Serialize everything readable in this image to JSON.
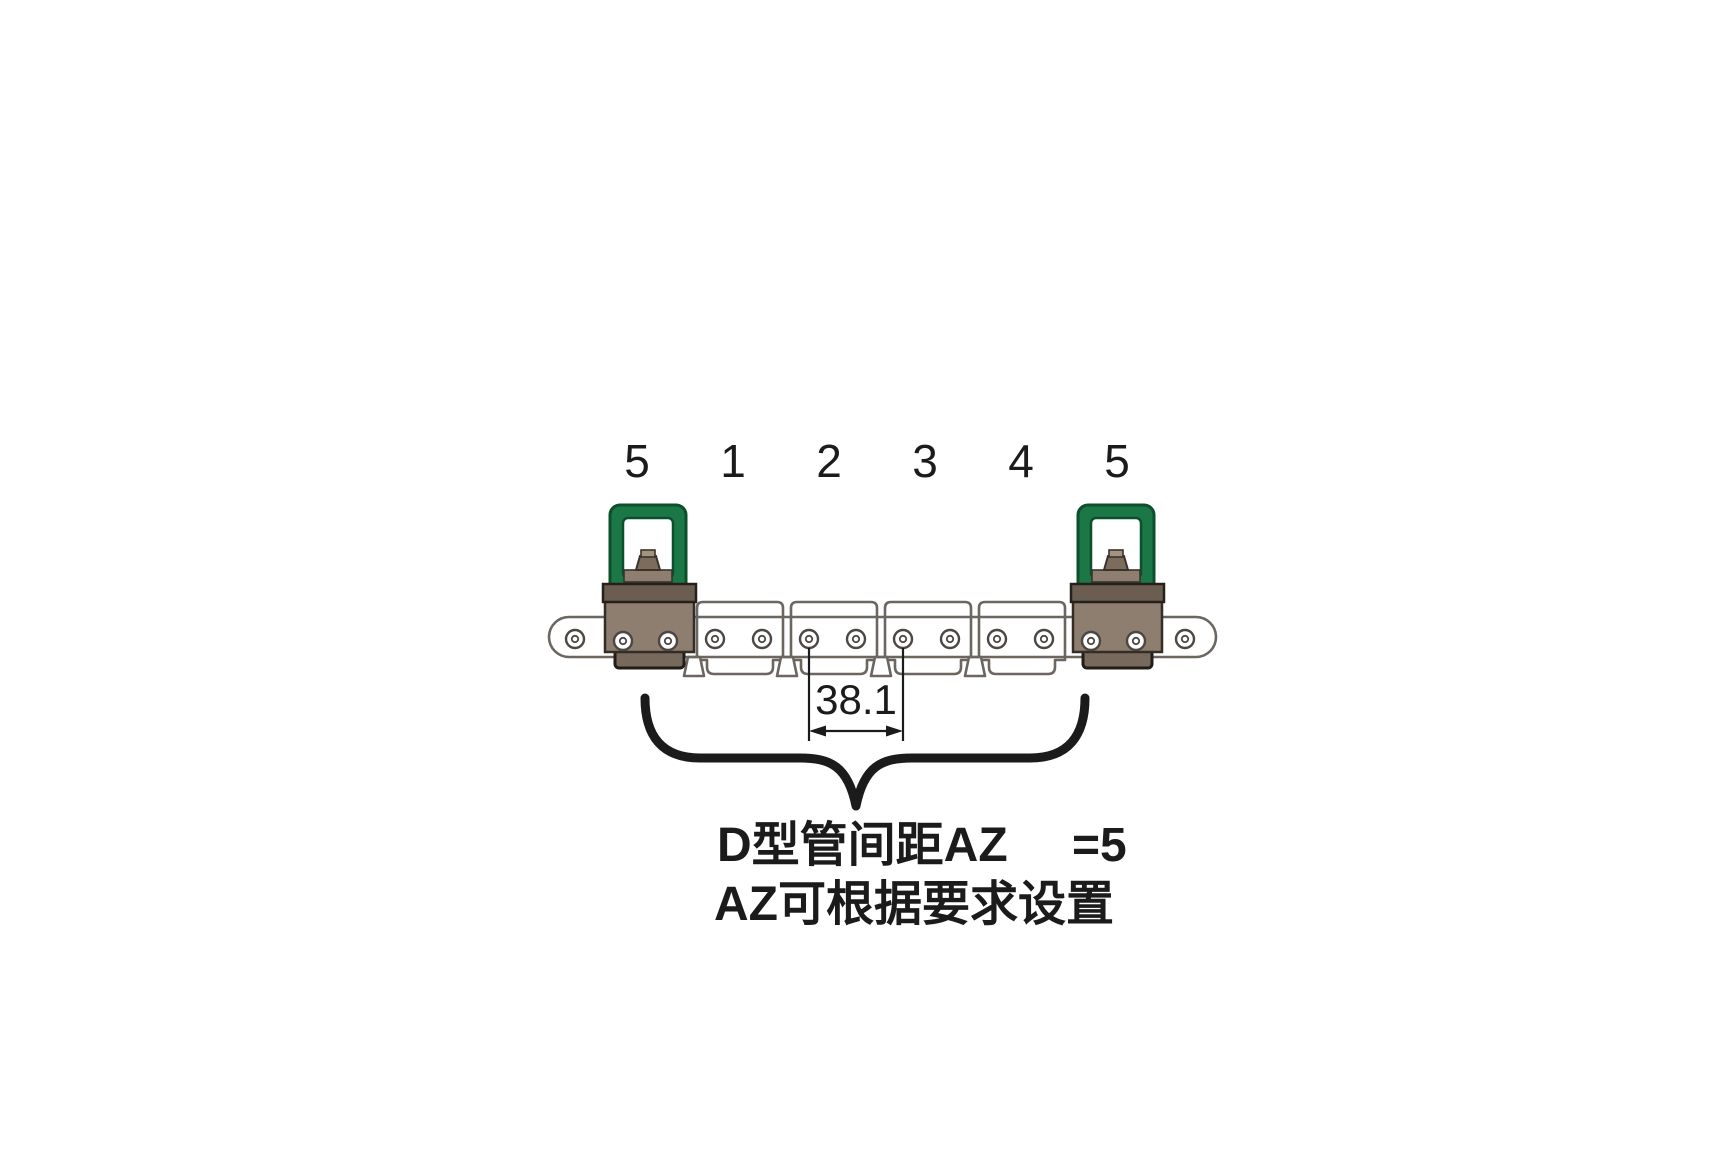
{
  "diagram": {
    "title_semantic": "tube-clamp-chain-assembly",
    "position_labels": [
      "5",
      "1",
      "2",
      "3",
      "4",
      "5"
    ],
    "dimension": {
      "value": "38.1"
    },
    "caption": {
      "line1": "D型管间距AZ",
      "line1_value": "=5",
      "line2": "AZ可根据要求设置"
    },
    "colors": {
      "handle_green": "#1b7846",
      "handle_green_dark": "#0c4f2b",
      "block_brown": "#8d7e70",
      "block_brown_dark": "#6b5d50",
      "block_brown_lip": "#776a5d",
      "outline_gray": "#6b665f",
      "hole_stroke": "#4c4742",
      "ink": "#1b1b1b"
    }
  }
}
